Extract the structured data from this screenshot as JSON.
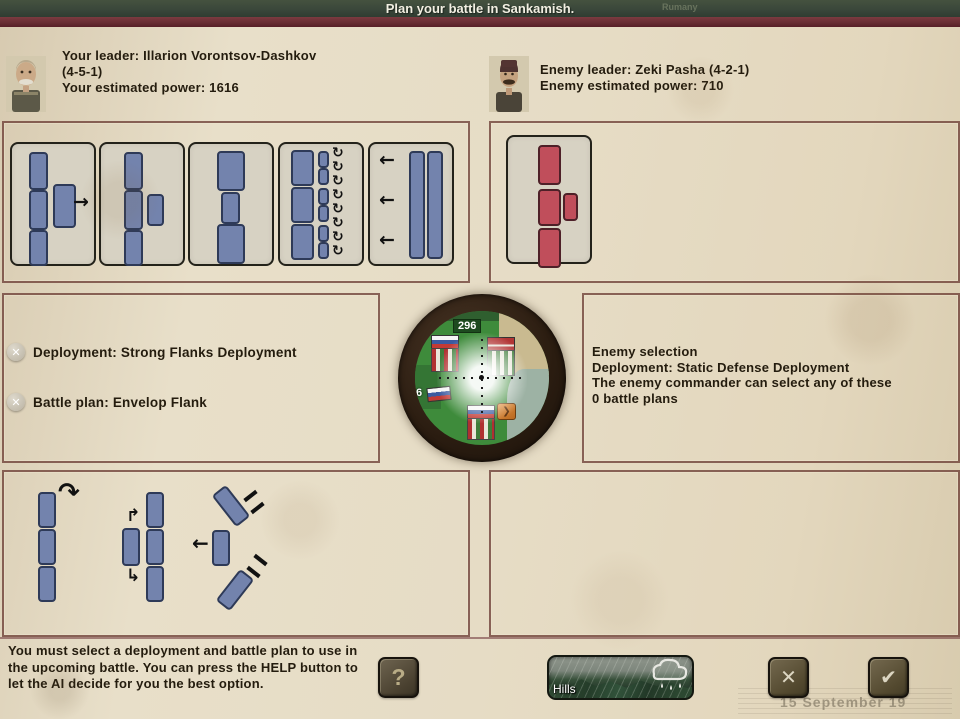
{
  "title_bar": {
    "title": "Plan your battle in Sankamish.",
    "background_map_label": "Rumany"
  },
  "leaders": {
    "player": {
      "line1": "Your leader: Illarion Vorontsov-Dashkov",
      "line2": "(4-5-1)",
      "line3": "Your estimated power: 1616"
    },
    "enemy": {
      "line1": "Enemy leader: Zeki Pasha (4-2-1)",
      "line2": "Enemy estimated power: 710"
    }
  },
  "selection_panel": {
    "deployment": "Deployment: Strong Flanks Deployment",
    "battle_plan": "Battle plan: Envelop Flank"
  },
  "enemy_panel": {
    "line1": "Enemy selection",
    "line2": "Deployment: Static Defense Deployment",
    "line3": "The enemy commander can select any of these",
    "line4": "0 battle plans"
  },
  "minimap": {
    "counter_label": "296",
    "side_label": "6",
    "orange_icon": "❯"
  },
  "footer": {
    "instruction": "You must select a deployment and battle plan to use in the upcoming battle. You can press the HELP button to let the AI decide for you the best option.",
    "terrain_label": "Hills",
    "date_text": "15 September 19"
  },
  "icons": {
    "help": "?",
    "close": "✕",
    "check": "✔",
    "remove": "✕",
    "arrow_right": "→",
    "arrow_left": "←",
    "cycle": "↻",
    "curve_right": "↷",
    "elbow_up": "↱",
    "elbow_down": "↳"
  },
  "colors": {
    "topbar_green": "#3d4a3d",
    "maroon_accent": "#6e3036",
    "parchment": "#e5dbc5",
    "player_unit_blue": "#7383ad",
    "enemy_unit_red": "#c04e5b",
    "button_brown": "#4c4434"
  }
}
